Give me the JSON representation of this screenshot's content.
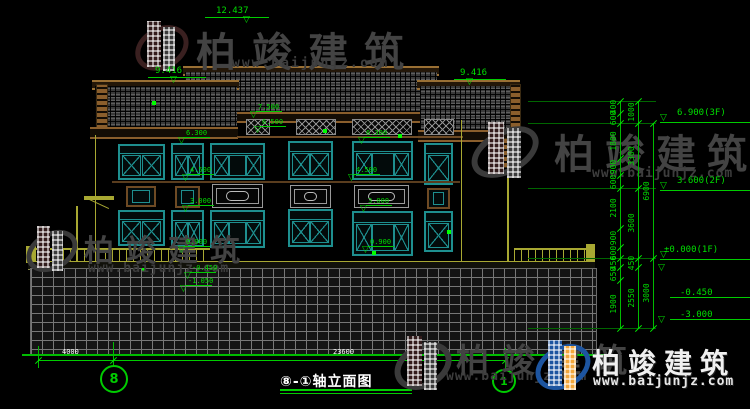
{
  "background": "#000000",
  "colors": {
    "line_green": "#00cc00",
    "text_green": "#00dd00",
    "white": "#ffffff",
    "window_teal": "#1e8f8f",
    "roof_brown": "#8a5e2c",
    "olive": "#a8a832",
    "watermark_gray": "#434343",
    "logo_blue": "#1d55a0",
    "logo_orange": "#f2a73b"
  },
  "watermark": {
    "brand": "柏竣建筑",
    "url": "www.baijunjz.com"
  },
  "title_block": {
    "label": "⑧-①轴立面图"
  },
  "axis_bubbles": {
    "left": "8",
    "right": "1"
  },
  "bottom_dimensions": {
    "segment": "4000",
    "total": "23600"
  },
  "top_level_markers": {
    "ridge": "12.437",
    "left_eave": "9.416",
    "right_eave": "9.416"
  },
  "right_level_flags": [
    "6.900(3F)",
    "3.600(2F)",
    "±0.000(1F)",
    "-0.450",
    "-3.000"
  ],
  "facade_level_markers": [
    "7.500",
    "6.500",
    "6.300",
    "4.500",
    "3.000",
    "0.900",
    "6.300",
    "4.500",
    "3.000",
    "0.900",
    "-0.450",
    "-1.050"
  ],
  "right_dim_chains": {
    "inner": [
      "400",
      "600",
      "1800",
      "900",
      "600",
      "2100",
      "900",
      "600",
      "450",
      "650",
      "1900"
    ],
    "middle": [
      "1000",
      "3300",
      "3600",
      "450",
      "2550"
    ],
    "outer": [
      "6900",
      "3000"
    ]
  }
}
